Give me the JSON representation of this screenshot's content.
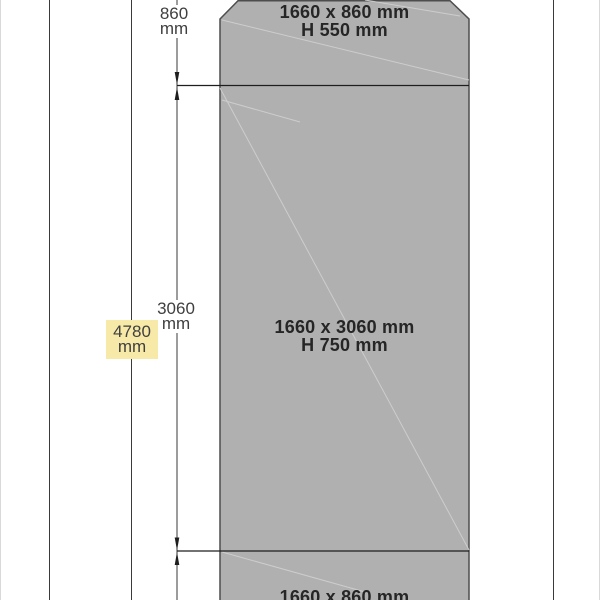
{
  "drawing": {
    "sections": [
      {
        "size": "1660 x 860 mm",
        "height": "H 550 mm"
      },
      {
        "size": "1660 x 3060 mm",
        "height": "H 750 mm"
      },
      {
        "size": "1660 x 860 mm"
      }
    ],
    "dim_labels": [
      {
        "value": "860",
        "unit": "mm",
        "highlighted": false
      },
      {
        "value": "3060",
        "unit": "mm",
        "highlighted": false
      },
      {
        "value": "4780",
        "unit": "mm",
        "highlighted": true
      }
    ],
    "colors": {
      "panel_fill": "#b0b0b0",
      "panel_edge": "#4d4d4d",
      "line": "#3a3a3a",
      "divider": "#1e1e1e",
      "crease": "#cdcdcd",
      "text_bold": "#262626",
      "text_dim": "#3f3f3f",
      "highlight_bg": "#f7e9a7",
      "border_faint": "#d9d9d9"
    }
  }
}
